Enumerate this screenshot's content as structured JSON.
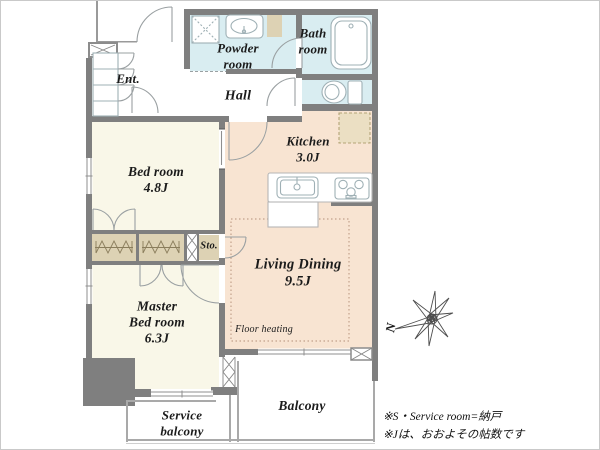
{
  "rooms": {
    "powder": {
      "line1": "Powder",
      "line2": "room"
    },
    "bath": {
      "line1": "Bath",
      "line2": "room"
    },
    "entrance": {
      "label": "Ent."
    },
    "hall": {
      "label": "Hall"
    },
    "kitchen": {
      "line1": "Kitchen",
      "line2": "3.0J"
    },
    "bedroom": {
      "line1": "Bed room",
      "line2": "4.8J"
    },
    "storage": {
      "label": "Sto."
    },
    "living_dining": {
      "line1": "Living Dining",
      "line2": "9.5J",
      "floor_heating": "Floor heating"
    },
    "master_bedroom": {
      "line1": "Master",
      "line2": "Bed room",
      "line3": "6.3J"
    },
    "service_balcony": {
      "line1": "Service",
      "line2": "balcony"
    },
    "balcony": {
      "label": "Balcony"
    }
  },
  "compass": {
    "north_label": "N"
  },
  "notes": {
    "line1": "※S・Service room=納戸",
    "line2": "※Jは、おおよその帖数です"
  },
  "colors": {
    "wall": "#7f7f7f",
    "wet_room": "#d9edf1",
    "living": "#f8e4d2",
    "bedroom": "#f9f7e8",
    "closet": "#ddd2b4",
    "fridge": "#ebdfc3",
    "outline": "#9aa0a2"
  }
}
